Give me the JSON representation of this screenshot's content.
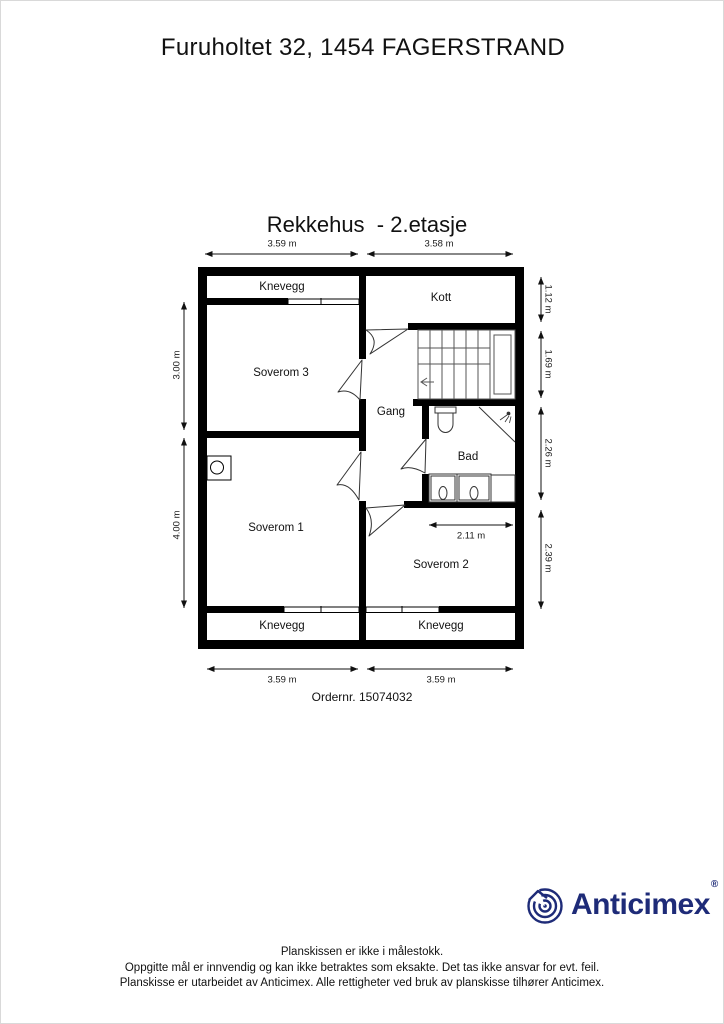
{
  "page": {
    "title": "Furuholtet 32, 1454 FAGERSTRAND"
  },
  "plan": {
    "title": "Rekkehus  - 2.etasje",
    "order_number": "Ordernr. 15074032",
    "rooms": {
      "knevegg_top": "Knevegg",
      "kott": "Kott",
      "soverom3": "Soverom 3",
      "gang": "Gang",
      "bad": "Bad",
      "soverom1": "Soverom 1",
      "soverom2": "Soverom 2",
      "knevegg_bottom_left": "Knevegg",
      "knevegg_bottom_right": "Knevegg"
    },
    "dimensions": {
      "top_left": "3.59 m",
      "top_right": "3.58 m",
      "left_top": "3.00 m",
      "left_bottom": "4.00 m",
      "right_1": "1.12 m",
      "right_2": "1.69 m",
      "right_3": "2.26 m",
      "right_4": "2.39 m",
      "soverom2_width": "2.11 m",
      "bottom_left": "3.59 m",
      "bottom_right": "3.59 m"
    }
  },
  "logo": {
    "brand": "Anticimex",
    "registered_mark": "®",
    "brand_color": "#1e2b78"
  },
  "footer": {
    "lines": [
      "Planskissen er ikke i målestokk.",
      "Oppgitte mål er innvendig og kan ikke betraktes som eksakte. Det tas ikke ansvar for evt. feil.",
      "Planskisse er utarbeidet av Anticimex. Alle rettigheter ved bruk av planskisse tilhører Anticimex."
    ]
  }
}
